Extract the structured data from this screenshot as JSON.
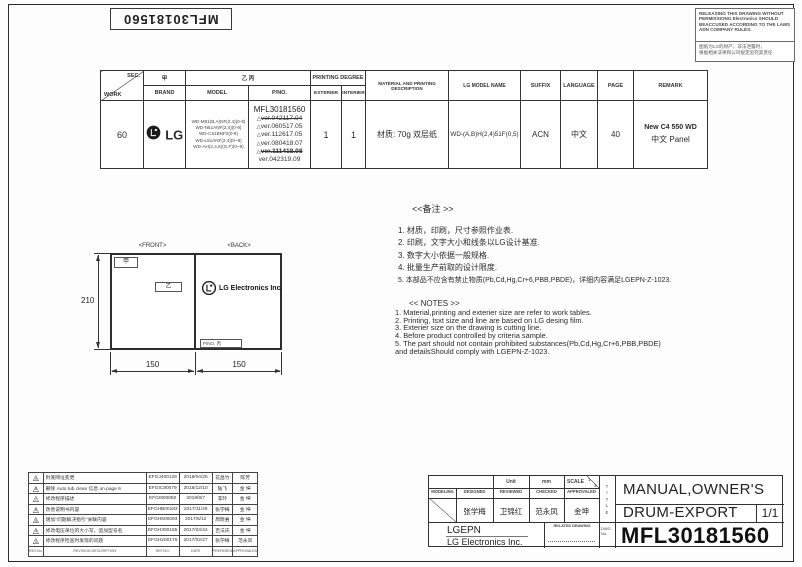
{
  "page": {
    "part_number_vertical": "MFL30181560",
    "warning": {
      "en": "RELEASING THIS DRAWING WITHOUT PERMISSIONG Electronics SHOULD BEACCUSED ACCORDING TO THE LAWS ADN COMPANY RULES.",
      "cn_line1": "图纸为LG的财产，非法泄露时，",
      "cn_line2": "根据相关法律和公司规定追究其责任"
    }
  },
  "icons": {
    "triangle": "△"
  },
  "work_table": {
    "headers": {
      "sec": "SEC.",
      "work": "WORK",
      "jia": "甲",
      "brand": "BRAND",
      "yi_bing": "乙 丙",
      "model": "MODEL",
      "pno": "P/NO.",
      "printing_degree": "PRINTING DEGREE",
      "exterier": "EXTERIER",
      "interier": "INTERIER",
      "material": "MATERIAL AND PRINTING DESCRIPTION",
      "lg_model_name": "LG MODEL NAME",
      "suffix": "SUFFIX",
      "language": "LANGUAGE",
      "page": "PAGE",
      "remark": "REMARK"
    },
    "row": {
      "work": "60",
      "brand_logo": "LG",
      "models": [
        "WD-M51(B,A)NF(2,4)(0-9)",
        "WD-N51ANF(2,4)(0-9)",
        "WD-C51BNF2(0-9)",
        "WD-L51ANF(2,4)(0~9)",
        "WD-AH(2,4,5)(G,F)(0~9)"
      ],
      "pno_main": "MFL30181560",
      "pno_versions": [
        "ver.042117.04",
        "ver.060517.05",
        "ver.112617.05",
        "ver.080418.07",
        "ver.111418.08",
        "ver.042319.09"
      ],
      "exterier": "1",
      "interier": "1",
      "material": "材质: 70g 双层纸",
      "lg_model_name": "WD-(A,B)H(2,4)51F(0,5)",
      "suffix": "ACN",
      "language": "中文",
      "page": "40",
      "remark_line1": "New C4 550 WD",
      "remark_line2": "中文  Panel"
    }
  },
  "notes_cn": {
    "title": "<<备注 >>",
    "items": [
      "1.  材质，印刷，尺寸参照作业表.",
      "2.  印刷，文字大小和线条以LG设计基准.",
      "3.  数字大小依据一般规格.",
      "4.  批量生产前取的设计限度.",
      "5.  本部品不应含有禁止物质(Pb,Cd,Hg,Cr+6,PBB,PBDE)，详细内容满足LGEPN-Z-1023."
    ]
  },
  "notes_en": {
    "title": "<< NOTES >>",
    "items": [
      "1. Material,printing and exterier size are refer to work tables.",
      "2. Printing, tsxt  size and line are based on LG desing film.",
      "3. Exterier size on the drawing is cutting line.",
      "4. Before product controlled by criteria sample.",
      "5. The part should not contain prohibited substances(Pb,Cd,Hg,Cr+6,PBB,PBDE)",
      "    and detailsShould comply with LGEPN-Z-1023."
    ]
  },
  "drawing": {
    "front_label": "<FRONT>",
    "back_label": "<BACK>",
    "marker_jia": "甲",
    "marker_yi": "乙",
    "pno_marker": "P/NO. 丙",
    "company": "LG Electronics Inc.",
    "dim_height": "210",
    "dim_front_width": "150",
    "dim_back_width": "150"
  },
  "revisions": {
    "rows": [
      {
        "no": "9",
        "desc": "封底网址变更",
        "ref": "EFGJ400129",
        "date": "2019/04/25",
        "prep": "花昌竹",
        "appr": "陈芳"
      },
      {
        "no": "8",
        "desc": "删除 Auto tub clean 信息 on page 9",
        "ref": "EFGIC80079",
        "date": "2018/12/10",
        "prep": "陆飞",
        "appr": "金 坤"
      },
      {
        "no": "7",
        "desc": "修改程序描述",
        "ref": "EFGI800050",
        "date": "2018/8/7",
        "prep": "李玲",
        "appr": "金 坤"
      },
      {
        "no": "6",
        "desc": "改善说明书内容",
        "ref": "EFGHB00183",
        "date": "2017/11/29",
        "prep": "张学梅",
        "appr": "金 坤"
      },
      {
        "no": "5",
        "desc": "增加\"问题解决指引\"关联内容",
        "ref": "EFGH600093",
        "date": "2017/6/12",
        "prep": "周晓君",
        "appr": "金 坤"
      },
      {
        "no": "4",
        "desc": "修改电压单位的大小写，追加型号名",
        "ref": "EFGH300155",
        "date": "2017/04/24",
        "prep": "吉法庆",
        "appr": "金 坤"
      },
      {
        "no": "3",
        "desc": "修改程序检查时发现的问题",
        "ref": "EFGH200176",
        "date": "2017/02/27",
        "prep": "张学梅",
        "appr": "范永凤"
      }
    ],
    "footer": {
      "no": "REV.No.",
      "desc": "REVISION DESCRIPTION",
      "ref": "REF.NO.",
      "date": "DATE",
      "prep": "PREPARED",
      "appr": "APPROVALED"
    }
  },
  "title_block": {
    "unit_label": "Unit",
    "unit_value": "mm",
    "scale_label": "SCALE",
    "scale_num": "1",
    "scale_den": "1",
    "modeling": "MODELING",
    "designed": "DESIGNED",
    "reviewed": "REVIEWED",
    "checked": "CHECKED",
    "approvaled": "APPROVALED",
    "designed_name": "张学梅",
    "reviewed_name": "卫锦红",
    "checked_name": "范永凤",
    "approvaled_name": "金坤",
    "company_short": "LGEPN",
    "company_full": "LG Electronics Inc.",
    "related_drawing": "RELATED DRAWING",
    "dwg_label1": "DWG.",
    "dwg_label2": "No.",
    "title_letters": [
      "T",
      "I",
      "T",
      "L",
      "E"
    ],
    "title1": "MANUAL,OWNER'S",
    "title2": "DRUM-EXPORT",
    "sheet": "1/1",
    "drawing_no": "MFL30181560"
  }
}
